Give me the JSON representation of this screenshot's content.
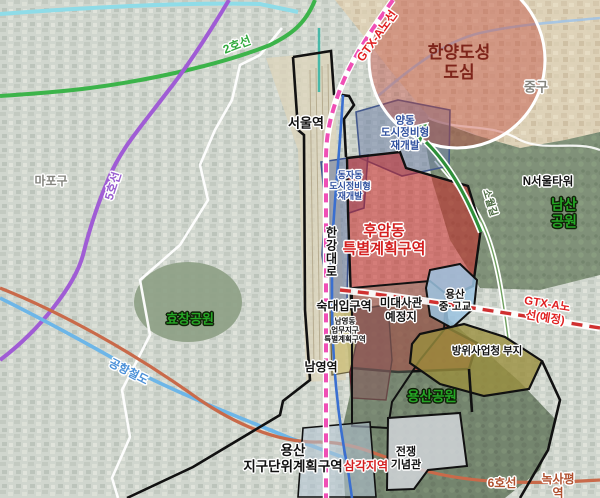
{
  "map": {
    "districts": {
      "mapo": "마포구",
      "junggu": "중구"
    },
    "stations": {
      "seoul": "서울역",
      "sookdae": "숙대입구역",
      "namyeong": "남영역",
      "samgakji": "삼각지역",
      "noksapyeong": "녹사평역"
    },
    "transit_lines": {
      "line2": "2호선",
      "line5": "5호선",
      "line6": "6호선",
      "airport_rail": "공항철도",
      "gtx_a": "GTX-A노선",
      "gtx_a_planned": "GTX-A노선(예정)"
    },
    "roads": {
      "hangang_daero": "한강대로",
      "sowolgil": "소월길"
    },
    "parks": {
      "namsan": "남산공원",
      "hyochang": "효창공원",
      "yongsan": "용산공원"
    },
    "landmarks": {
      "n_seoul_tower": "N서울타워",
      "war_memorial": "전쟁\n기념관"
    },
    "planning_zones": {
      "hanyang_city_center": "한양도성\n도심",
      "yangdong_redev": "양동\n도시정비형\n재개발",
      "dongja_redev": "동자동\n도시정비형\n재개발",
      "huam_special": "후암동\n특별계획구역",
      "namyeong_business": "남영동\n업무지구\n특별계획구역",
      "us_embassy_site": "미대사관\n예정지",
      "yongsan_school": "용산\n중·고교",
      "defense_agency_site": "방위사업청 부지",
      "yongsan_district_unit": "용산\n지구단위계획구역"
    },
    "colors": {
      "line2_green": "#2faa3c",
      "line5_purple": "#9a5fd0",
      "line6_brown": "#b0502e",
      "airport_rail_blue": "#4a90d8",
      "gtx_pink": "#ef4fb5",
      "gtx_label_red": "#e02020",
      "huam_zone_red": "#d42020",
      "redev_zone_blue": "#2e4f9e",
      "park_label_green": "#25a625",
      "hanyang_maroon": "#7e241a",
      "defense_olive": "#9a8f3e",
      "school_lightblue": "#9bc3e1"
    }
  }
}
